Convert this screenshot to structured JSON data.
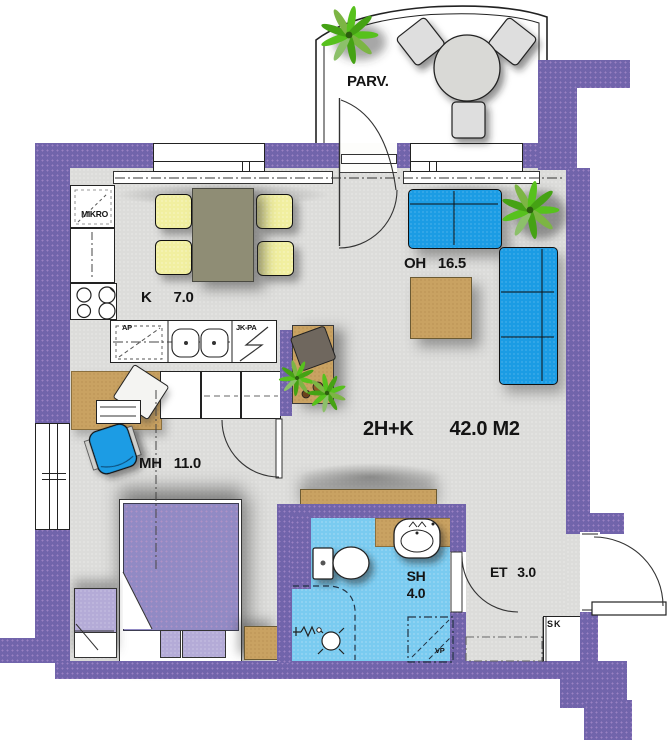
{
  "title": {
    "layout": "2H+K",
    "area": "42.0 M2"
  },
  "rooms": {
    "kitchen": {
      "abbr": "K",
      "area": "7.0"
    },
    "living_room": {
      "abbr": "OH",
      "area": "16.5"
    },
    "bedroom": {
      "abbr": "MH",
      "area": "11.0"
    },
    "bathroom": {
      "abbr": "SH",
      "area": "4.0"
    },
    "entry": {
      "abbr": "ET",
      "area": "3.0"
    },
    "balcony": {
      "abbr": "PARV."
    }
  },
  "fixtures": {
    "microwave": "MIKRO",
    "dishwasher": "AP",
    "fridge_freezer": "JK-PA",
    "washer_reservation": "VP",
    "cleaning_closet": "SK"
  },
  "colors": {
    "wall": "#7164ab",
    "floor": "#dcdcda",
    "bathroom_floor": "#7acbf0",
    "sofa_blue": "#1b9ce4",
    "wood_tan": "#c9a262",
    "bed_purple": "#918ac4",
    "cushion_lavender": "#b4abd7",
    "chair_yellow": "#f1efa0",
    "dining_table_olive": "#8f8d75",
    "plant_green": "#57c11d"
  }
}
